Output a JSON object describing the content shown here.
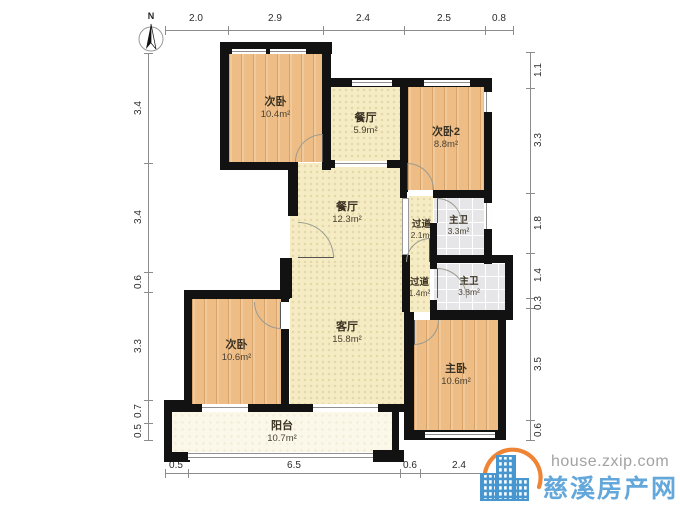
{
  "north_label": "N",
  "dims": {
    "top": [
      "2.0",
      "2.9",
      "2.4",
      "2.5",
      "0.8"
    ],
    "bottom": [
      "0.5",
      "6.5",
      "0.6",
      "2.4"
    ],
    "left": [
      "3.4",
      "3.4",
      "0.6",
      "3.3",
      "0.7",
      "0.5"
    ],
    "right": [
      "1.1",
      "3.3",
      "1.8",
      "1.4",
      "0.3",
      "3.5",
      "0.6"
    ]
  },
  "rooms": [
    {
      "name": "次卧",
      "area": "10.4m²",
      "floor": "wood"
    },
    {
      "name": "餐厅",
      "area": "5.9m²",
      "floor": "tile"
    },
    {
      "name": "次卧2",
      "area": "8.8m²",
      "floor": "wood"
    },
    {
      "name": "餐厅",
      "area": "12.3m²",
      "floor": "tile"
    },
    {
      "name": "过道",
      "area": "2.1m²",
      "floor": "tile"
    },
    {
      "name": "主卫",
      "area": "3.3m²",
      "floor": "bath"
    },
    {
      "name": "过道",
      "area": "1.4m²",
      "floor": "tile"
    },
    {
      "name": "主卫",
      "area": "3.8m²",
      "floor": "bath"
    },
    {
      "name": "次卧",
      "area": "10.6m²",
      "floor": "wood"
    },
    {
      "name": "客厅",
      "area": "15.8m²",
      "floor": "tile"
    },
    {
      "name": "主卧",
      "area": "10.6m²",
      "floor": "wood"
    },
    {
      "name": "阳台",
      "area": "10.7m²",
      "floor": "balcony"
    }
  ],
  "watermark": {
    "url": "house.zxip.com",
    "site_name": "慈溪房产网"
  },
  "icons": {
    "north_compass": "compass-needle",
    "watermark_logo": "city-buildings-with-orange-arc"
  },
  "colors": {
    "wood": "#edbd85",
    "tile": "#f5ecc4",
    "bath": "#e6e6e8",
    "balcony": "#fbf8ea",
    "wall": "#121212",
    "brand_blue": "#4796d0",
    "brand_orange": "#ef8435"
  }
}
